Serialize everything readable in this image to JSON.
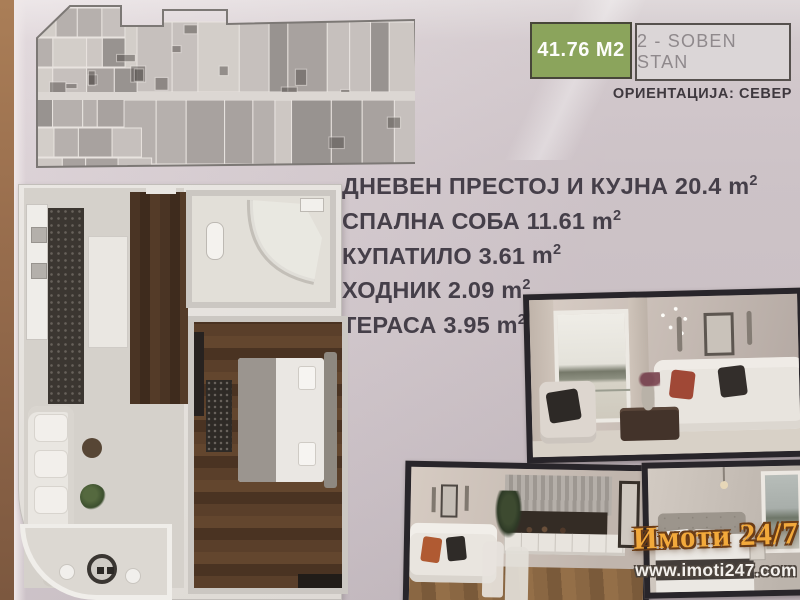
{
  "badges": {
    "area": "41.76 M2",
    "type": "2 - SOBEN STAN",
    "orientation": "ОРИЕНТАЦИЈА: СЕВЕР"
  },
  "rooms": [
    {
      "name": "ДНЕВЕН ПРЕСТОЈ И КУЈНА",
      "area": "20.4"
    },
    {
      "name": "СПАЛНА СОБА",
      "area": "11.61"
    },
    {
      "name": "КУПАТИЛО",
      "area": "3.61"
    },
    {
      "name": "ХОДНИК",
      "area": "2.09"
    },
    {
      "name": "ТЕРАСА",
      "area": "3.95"
    }
  ],
  "units": {
    "base": "m",
    "exp": "2"
  },
  "branding": {
    "logo_text": "Имоти 24/7",
    "website": "www.imoti247.com"
  },
  "colors": {
    "badge_green": "#8ba45c",
    "badge_gray": "#dbd6d7",
    "logo_gold": "#f2a93b",
    "page_paper": "#d8cdd2",
    "page_edge_brown": "#9a6f4e"
  }
}
